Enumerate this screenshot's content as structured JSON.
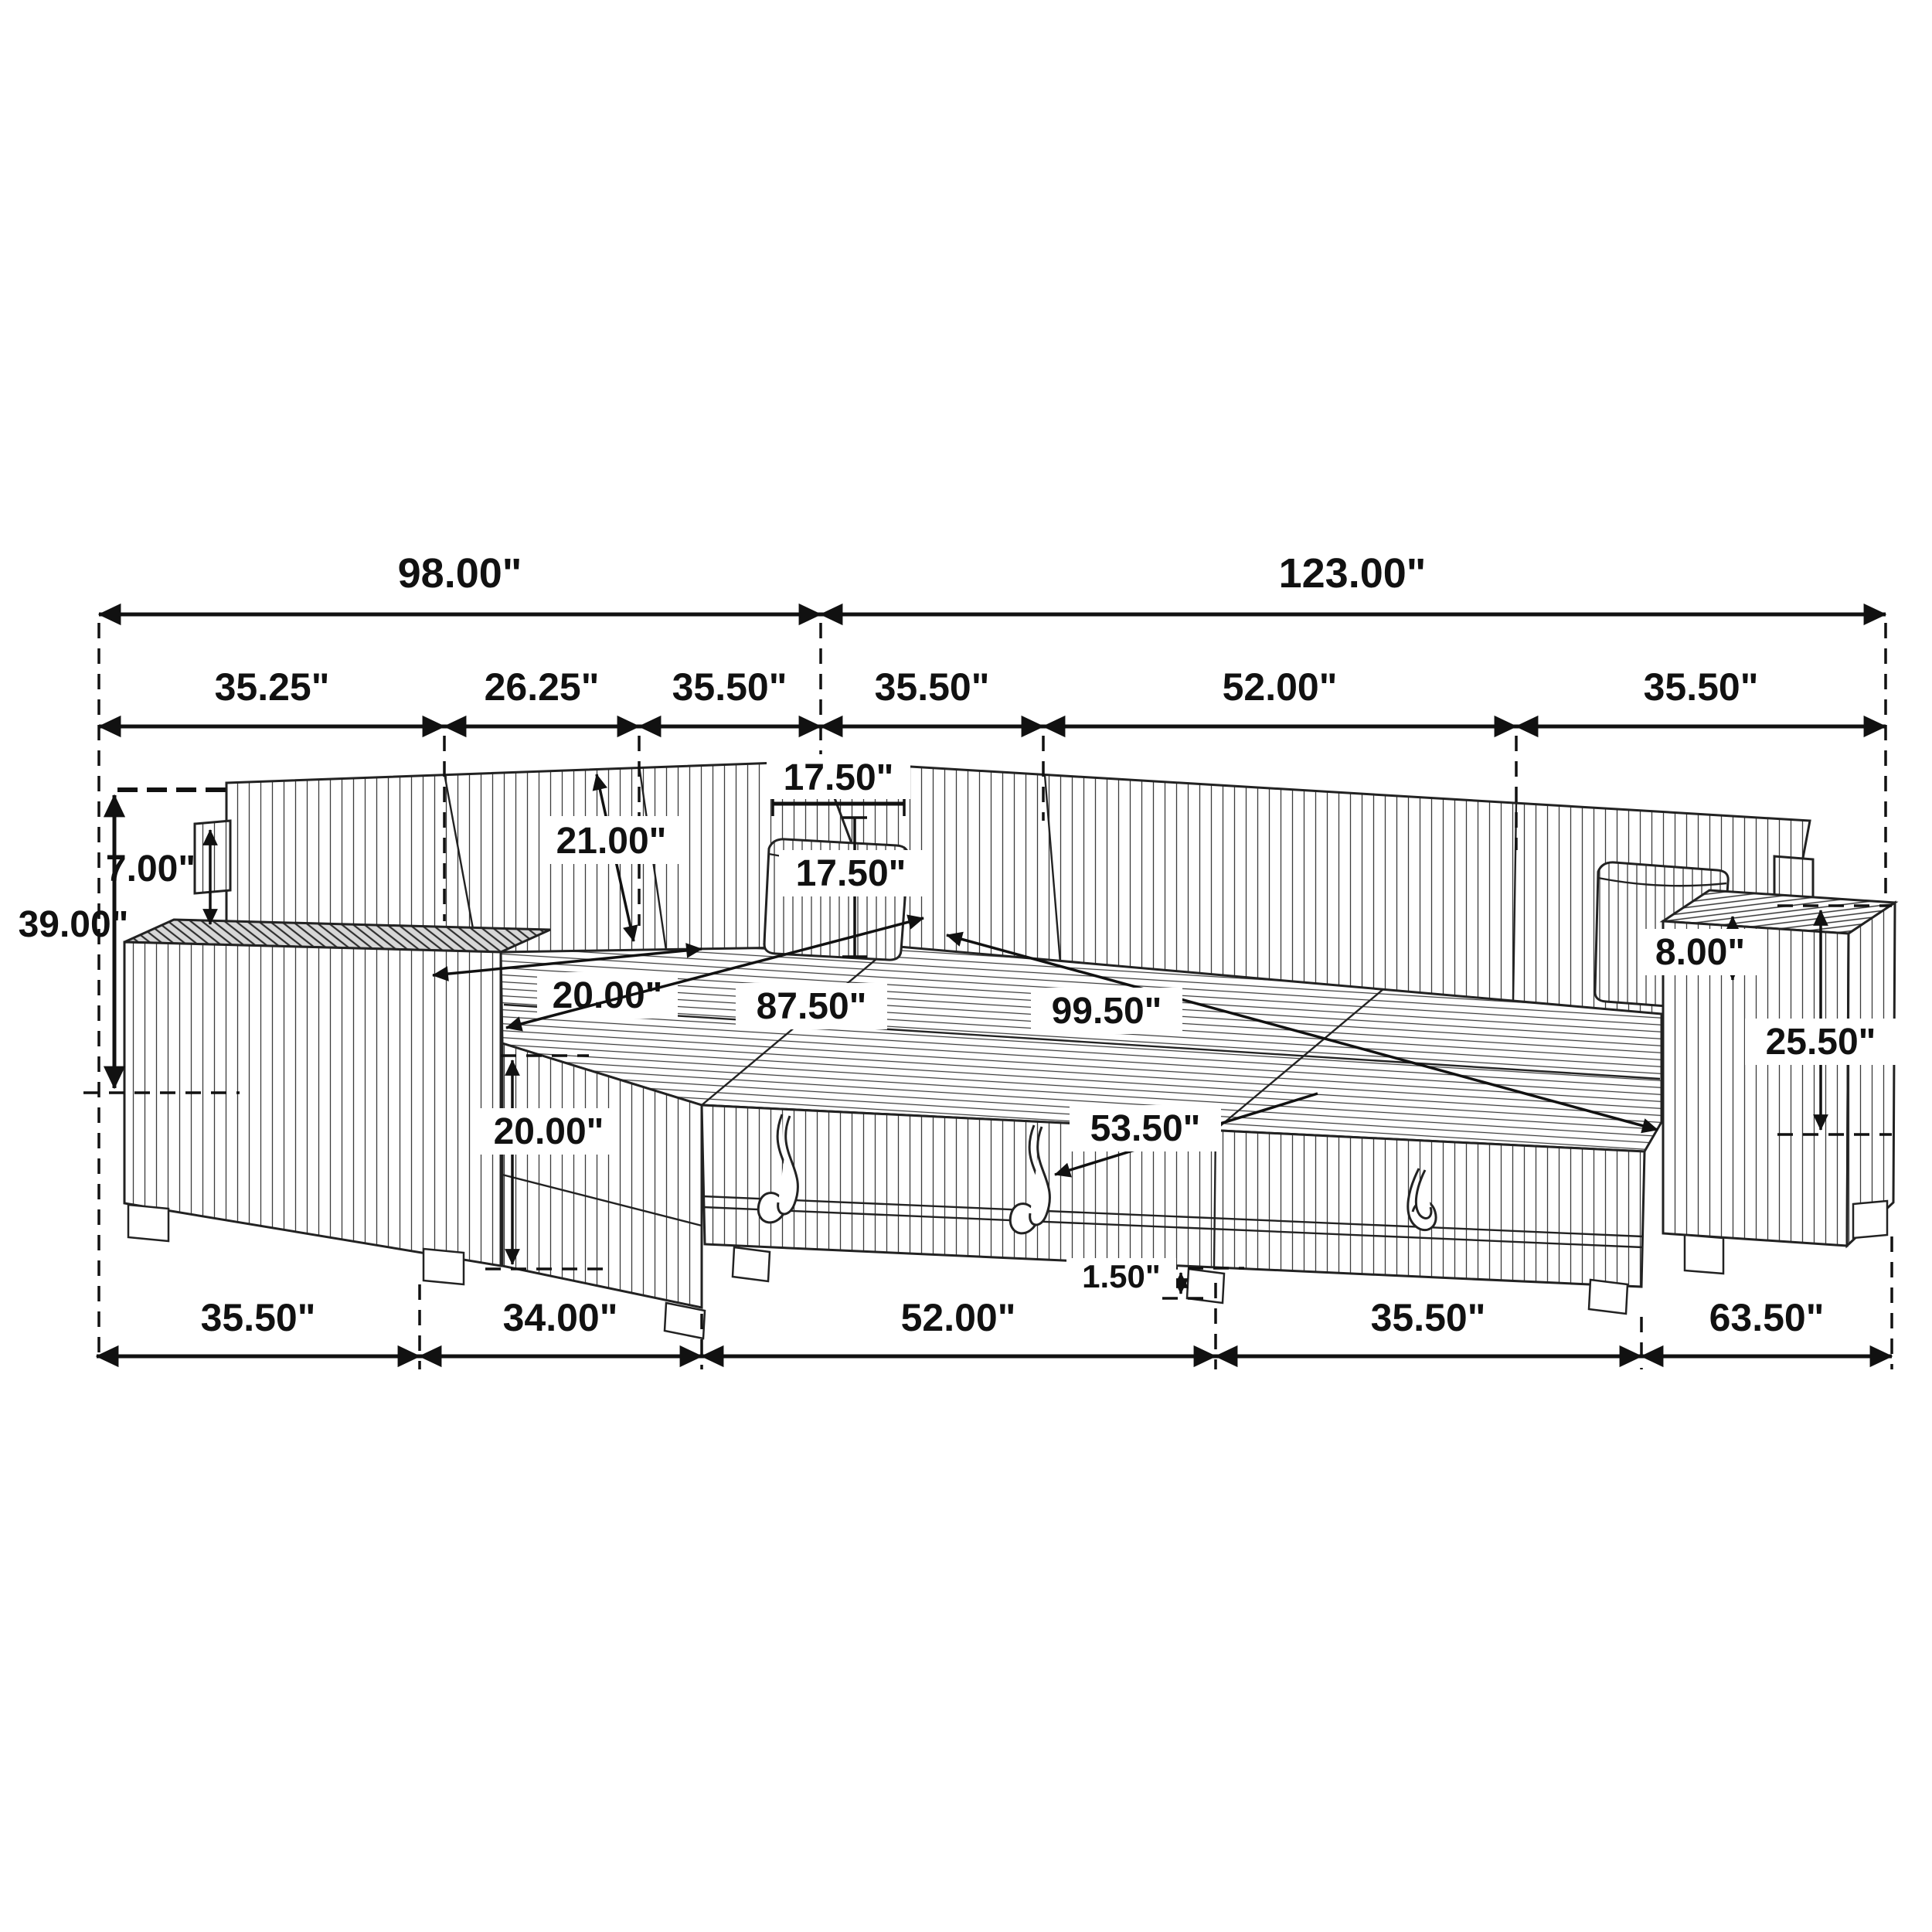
{
  "diagram": {
    "kind": "furniture-dimension-line-drawing",
    "subject": "U-shaped sleeper sectional sofa with chaise, armrest trays and pull-out bed, isometric line art with dimension arrows",
    "unit": "inches",
    "line_color": "#111111",
    "background_color": "#ffffff"
  },
  "dims": {
    "top": {
      "left": "98.00\"",
      "right": "123.00\""
    },
    "upper": [
      "35.25\"",
      "26.25\"",
      "35.50\"",
      "35.50\"",
      "52.00\"",
      "35.50\""
    ],
    "bottom": [
      "35.50\"",
      "34.00\"",
      "52.00\"",
      "35.50\"",
      "63.50\""
    ],
    "overall_height": "39.00\"",
    "back_post_height": "7.00\"",
    "back_cushion_length": "21.00\"",
    "pillow_width": "17.50\"",
    "pillow_height": "17.50\"",
    "seat_depth": "20.00\"",
    "left_section_depth": "87.50\"",
    "right_section_length": "99.50\"",
    "bed_front_depth": "53.50\"",
    "seat_height": "20.00\"",
    "armrest_above_seat": "8.00\"",
    "armrest_height": "25.50\"",
    "leg_clearance": "1.50\""
  }
}
